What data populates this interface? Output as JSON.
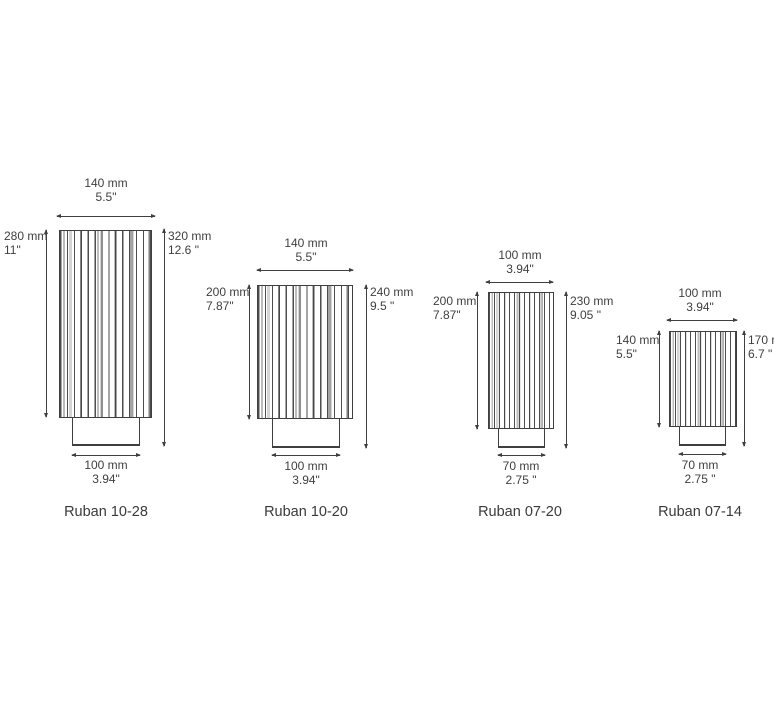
{
  "colors": {
    "line": "#3f3f3f",
    "text": "#3f3f3f",
    "background": "#ffffff"
  },
  "products": [
    {
      "name": "Ruban 10-28",
      "width_top": {
        "mm": "140 mm",
        "in": "5.5\""
      },
      "height_left": {
        "mm": "280 mm",
        "in": "11\""
      },
      "height_right": {
        "mm": "320 mm",
        "in": "12.6 \""
      },
      "width_bottom": {
        "mm": "100 mm",
        "in": "3.94\""
      }
    },
    {
      "name": "Ruban 10-20",
      "width_top": {
        "mm": "140 mm",
        "in": "5.5\""
      },
      "height_left": {
        "mm": "200 mm",
        "in": "7.87\""
      },
      "height_right": {
        "mm": "240 mm",
        "in": "9.5 \""
      },
      "width_bottom": {
        "mm": "100 mm",
        "in": "3.94\""
      }
    },
    {
      "name": "Ruban 07-20",
      "width_top": {
        "mm": "100 mm",
        "in": "3.94\""
      },
      "height_left": {
        "mm": "200 mm",
        "in": "7.87\""
      },
      "height_right": {
        "mm": "230 mm",
        "in": "9.05 \""
      },
      "width_bottom": {
        "mm": "70 mm",
        "in": "2.75 \""
      }
    },
    {
      "name": "Ruban 07-14",
      "width_top": {
        "mm": "100 mm",
        "in": "3.94\""
      },
      "height_left": {
        "mm": "140 mm",
        "in": "5.5\""
      },
      "height_right": {
        "mm": "170 m",
        "in": "6.7 \""
      },
      "width_bottom": {
        "mm": "70 mm",
        "in": "2.75 \""
      }
    }
  ]
}
